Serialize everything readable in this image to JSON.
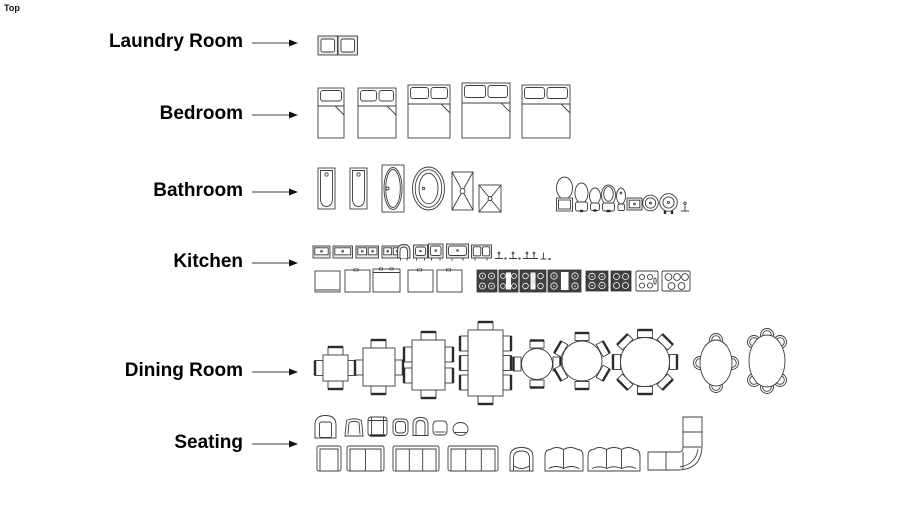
{
  "viewport": {
    "view_label": "Top"
  },
  "colors": {
    "background": "#ffffff",
    "line": "#3c3c3c",
    "text": "#000000",
    "cooktop_dark": "#404040",
    "shade": "#e9e9e9"
  },
  "sections": [
    {
      "label": "Laundry Room",
      "items": [
        "washer",
        "dryer"
      ]
    },
    {
      "label": "Bedroom",
      "items": [
        "twin-bed",
        "full-bed",
        "queen-bed",
        "king-bed",
        "california-king-bed"
      ]
    },
    {
      "label": "Bathroom",
      "items": [
        "bathtub",
        "bathtub-2",
        "drop-in-tub",
        "freestanding-oval-tub",
        "shower-stall",
        "corner-shower",
        "toilet-with-tank",
        "toilet-round",
        "toilet-compact",
        "toilet-elongated",
        "bidet",
        "rectangular-sink",
        "round-sink",
        "round-sink-with-faucet",
        "faucet"
      ]
    },
    {
      "label": "Kitchen",
      "items": [
        "bar-sink",
        "single-bowl-sink",
        "double-bowl-sink",
        "double-bowl-sink-2",
        "apron-sink",
        "square-sink",
        "square-sink-2",
        "wide-single-sink",
        "offset-double-sink",
        "faucet-1",
        "faucet-2",
        "double-handle-faucet",
        "faucet-3",
        "refrigerator-1",
        "refrigerator-2",
        "refrigerator-3",
        "refrigerator-4",
        "refrigerator-5",
        "gas-range-4-burner",
        "gas-range-narrow",
        "gas-range-6-burner",
        "range-with-griddle",
        "cooktop-4-burner",
        "cooktop-4-burner-2",
        "electric-cooktop",
        "electric-cooktop-2"
      ]
    },
    {
      "label": "Dining Room",
      "items": [
        "square-table-4-chairs",
        "rect-table-4-chairs",
        "rect-table-6-chairs",
        "rect-table-8-chairs",
        "round-table-4-chairs",
        "round-table-6-chairs",
        "round-table-8-chairs",
        "oval-table-4-chairs",
        "oval-table-6-chairs"
      ]
    },
    {
      "label": "Seating",
      "items": [
        "tub-chair",
        "slipper-chair",
        "club-chair",
        "armchair-small",
        "barrel-chair-small",
        "side-chair",
        "stool",
        "armchair",
        "loveseat",
        "sofa-3-seat",
        "sofa-3-seat-large",
        "barrel-chair",
        "curved-loveseat",
        "curved-sofa",
        "sectional-sofa"
      ]
    }
  ]
}
